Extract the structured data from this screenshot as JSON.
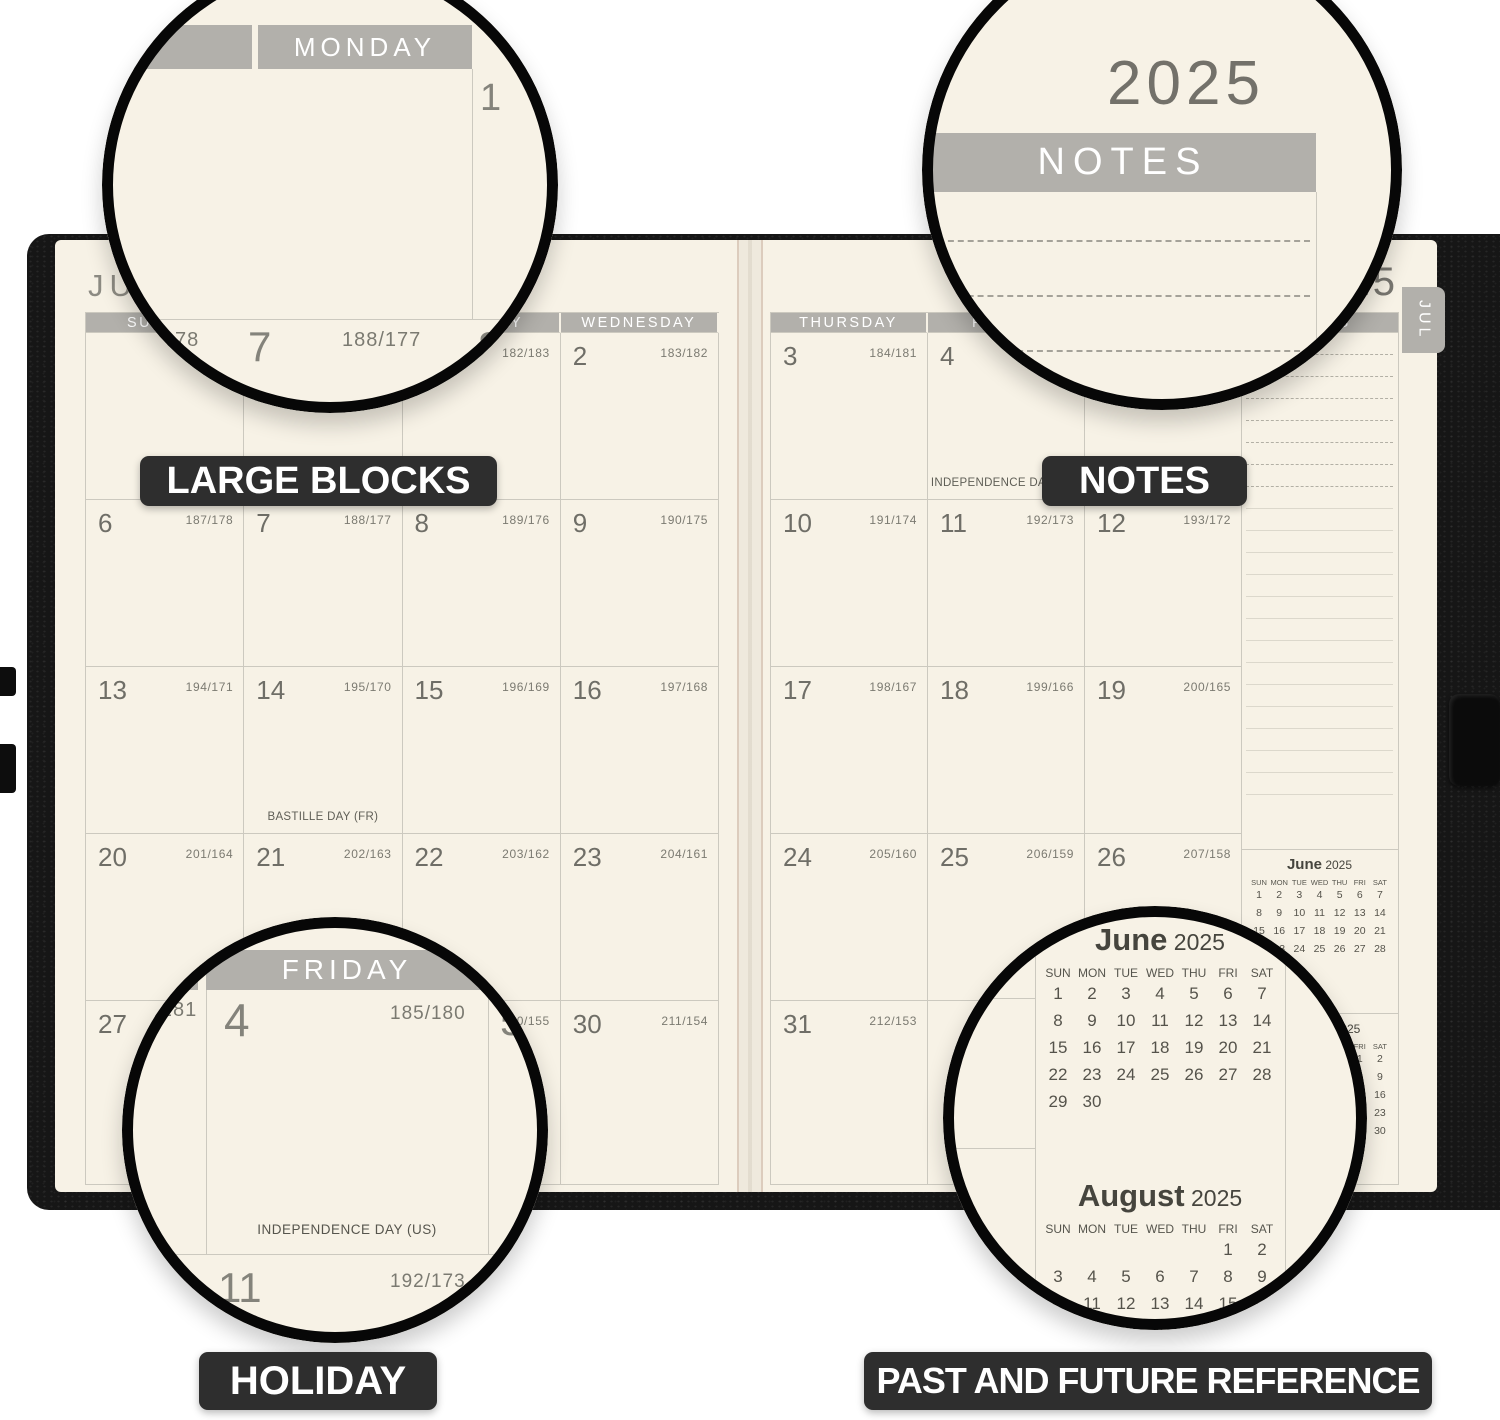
{
  "photo": {
    "background": "#ffffff",
    "cover_color": "#161616",
    "page_color": "#f7f2e6",
    "header_bar_color": "#b2b0ab",
    "badge_color": "#2e2e2e"
  },
  "badges": {
    "large_blocks": "LARGE BLOCKS",
    "notes": "NOTES",
    "holiday": "HOLIDAY",
    "reference": "PAST AND FUTURE REFERENCE"
  },
  "spread": {
    "month_title": "JULY",
    "year": "2025",
    "tab": "JUL",
    "notes_label": "NOTES",
    "calendar": {
      "left": {
        "headers": [
          "SUNDAY",
          "MONDAY",
          "TUESDAY",
          "WEDNESDAY"
        ],
        "rows": [
          [
            {
              "d": "",
              "j": ""
            },
            {
              "d": "",
              "j": ""
            },
            {
              "d": "1",
              "j": "182/183"
            },
            {
              "d": "2",
              "j": "183/182"
            }
          ],
          [
            {
              "d": "6",
              "j": "187/178"
            },
            {
              "d": "7",
              "j": "188/177"
            },
            {
              "d": "8",
              "j": "189/176"
            },
            {
              "d": "9",
              "j": "190/175"
            }
          ],
          [
            {
              "d": "13",
              "j": "194/171"
            },
            {
              "d": "14",
              "j": "195/170",
              "h": "BASTILLE DAY (FR)"
            },
            {
              "d": "15",
              "j": "196/169"
            },
            {
              "d": "16",
              "j": "197/168"
            }
          ],
          [
            {
              "d": "20",
              "j": "201/164"
            },
            {
              "d": "21",
              "j": "202/163"
            },
            {
              "d": "22",
              "j": "203/162"
            },
            {
              "d": "23",
              "j": "204/161"
            }
          ],
          [
            {
              "d": "27",
              "j": "208/157"
            },
            {
              "d": "28",
              "j": "209/156"
            },
            {
              "d": "29",
              "j": "210/155"
            },
            {
              "d": "30",
              "j": "211/154"
            }
          ]
        ]
      },
      "right": {
        "headers": [
          "THURSDAY",
          "FRIDAY",
          "SATURDAY"
        ],
        "rows": [
          [
            {
              "d": "3",
              "j": "184/181"
            },
            {
              "d": "4",
              "j": "185/180",
              "h": "INDEPENDENCE DAY (US)"
            },
            {
              "d": "5",
              "j": "186/179"
            }
          ],
          [
            {
              "d": "10",
              "j": "191/174"
            },
            {
              "d": "11",
              "j": "192/173"
            },
            {
              "d": "12",
              "j": "193/172"
            }
          ],
          [
            {
              "d": "17",
              "j": "198/167"
            },
            {
              "d": "18",
              "j": "199/166"
            },
            {
              "d": "19",
              "j": "200/165"
            }
          ],
          [
            {
              "d": "24",
              "j": "205/160"
            },
            {
              "d": "25",
              "j": "206/159"
            },
            {
              "d": "26",
              "j": "207/158"
            }
          ],
          [
            {
              "d": "31",
              "j": "212/153"
            },
            {
              "d": "",
              "j": ""
            },
            {
              "d": "",
              "j": ""
            }
          ]
        ]
      }
    },
    "mini_calendars": [
      {
        "month": "June",
        "year": "2025",
        "dow": [
          "SUN",
          "MON",
          "TUE",
          "WED",
          "THU",
          "FRI",
          "SAT"
        ],
        "blanks": 0,
        "days": 30
      },
      {
        "month": "August",
        "year": "2025",
        "dow": [
          "SUN",
          "MON",
          "TUE",
          "WED",
          "THU",
          "FRI",
          "SAT"
        ],
        "blanks": 5,
        "days": 31
      }
    ]
  },
  "magnifiers": {
    "m1": {
      "header": "MONDAY",
      "day_top": "1",
      "julian_left": "187/178",
      "day_mid": "7",
      "julian_mid": "188/177",
      "day_right": "8"
    },
    "m2": {
      "year": "2025",
      "header": "NOTES"
    },
    "m3": {
      "header": "FRIDAY",
      "julian_left": "184/181",
      "day": "4",
      "julian": "185/180",
      "day_next": "5",
      "holiday": "INDEPENDENCE DAY (US)",
      "day_below": "11",
      "julian_below": "192/173",
      "day_below_next": "12"
    }
  }
}
